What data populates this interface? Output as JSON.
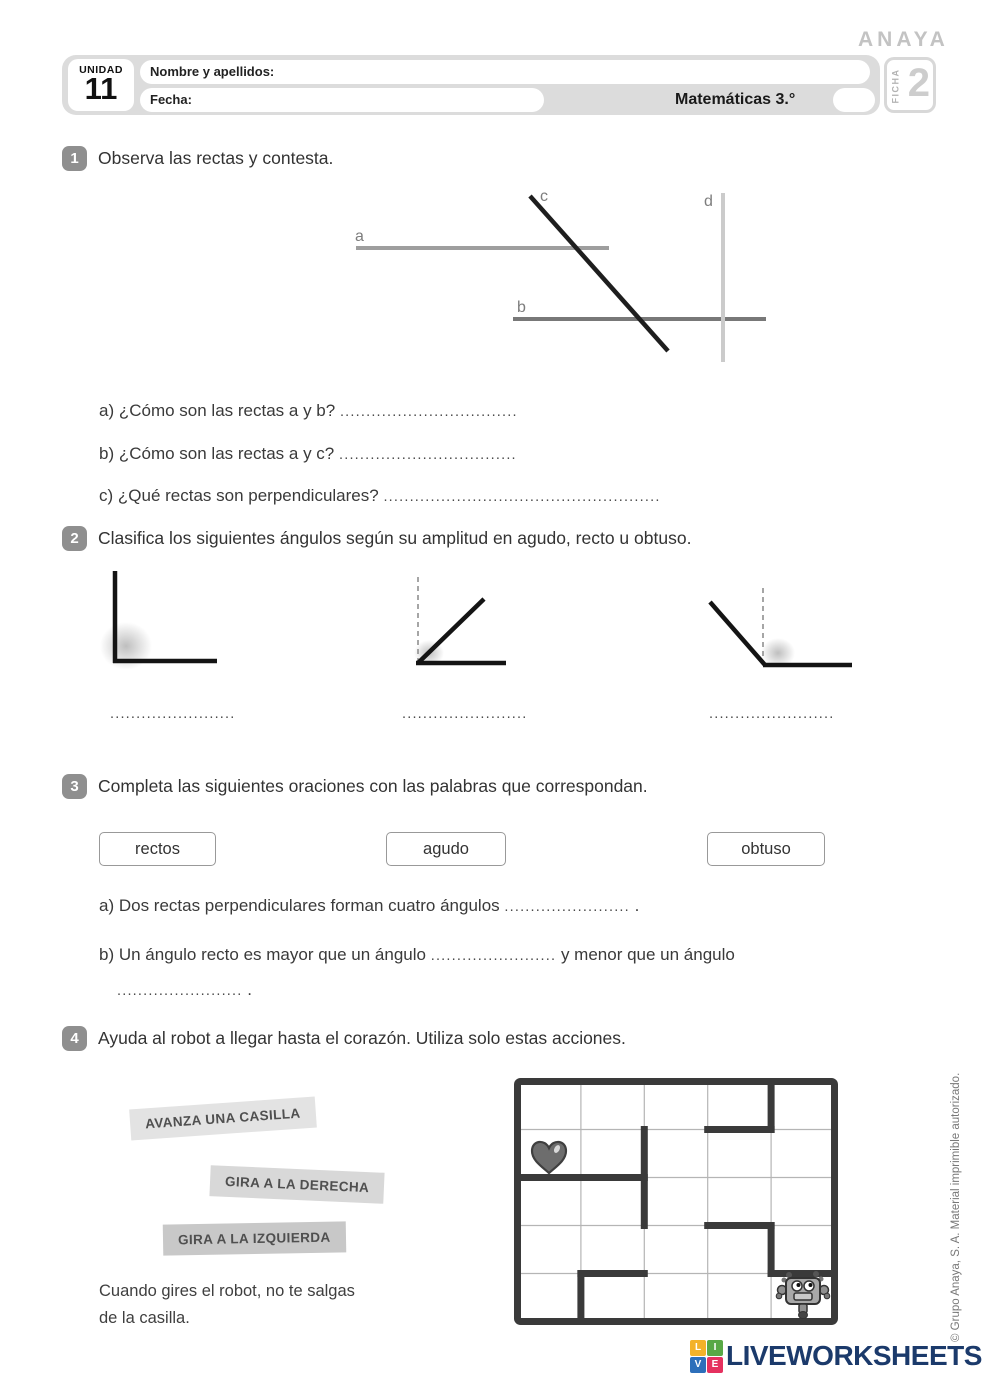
{
  "brand": {
    "publisher_logo": "ANAYA",
    "copyright_vertical": "© Grupo Anaya, S. A. Material imprimible autorizado."
  },
  "header": {
    "unidad_label": "UNIDAD",
    "unidad_number": "11",
    "nombre_label": "Nombre y apellidos:",
    "fecha_label": "Fecha:",
    "subject": "Matemáticas 3.°",
    "ficha_label": "FICHA",
    "ficha_number": "2"
  },
  "exercise1": {
    "number": "1",
    "title": "Observa las rectas y contesta.",
    "line_labels": {
      "a": "a",
      "b": "b",
      "c": "c",
      "d": "d"
    },
    "questions": [
      {
        "text": "a) ¿Cómo son las rectas a y b?",
        "dots": ".................................."
      },
      {
        "text": "b) ¿Cómo son las rectas a y c?",
        "dots": ".................................."
      },
      {
        "text": "c) ¿Qué rectas son perpendiculares?",
        "dots": "....................................................."
      }
    ]
  },
  "exercise2": {
    "number": "2",
    "title": "Clasifica los siguientes ángulos según su amplitud en agudo, recto u obtuso.",
    "answer_dots": "........................"
  },
  "exercise3": {
    "number": "3",
    "title": "Completa las siguientes oraciones con las palabras que correspondan.",
    "word_options": [
      "rectos",
      "agudo",
      "obtuso"
    ],
    "sentence_a": {
      "text": "a) Dos rectas perpendiculares forman cuatro ángulos",
      "dots": "........................",
      "period": " ."
    },
    "sentence_b": {
      "text": "b) Un ángulo recto es mayor que un ángulo",
      "dots1": "........................",
      "text2": " y menor que un ángulo",
      "dots2": "........................",
      "period": " ."
    }
  },
  "exercise4": {
    "number": "4",
    "title": "Ayuda al robot a llegar hasta el corazón. Utiliza solo estas acciones.",
    "actions": [
      "AVANZA UNA CASILLA",
      "GIRA A LA DERECHA",
      "GIRA A LA IZQUIERDA"
    ],
    "note_line1": "Cuando gires el robot, no te salgas",
    "note_line2": "de la casilla.",
    "maze": {
      "rows": 5,
      "cols": 5,
      "heart_cell": [
        1,
        0
      ],
      "robot_cell": [
        4,
        4
      ]
    }
  },
  "footer": {
    "logo_text": "LIVEWORKSHEETS",
    "logo_text_color": "#1b3a6b",
    "logo_squares": [
      {
        "letter": "L",
        "color": "#f3b229"
      },
      {
        "letter": "I",
        "color": "#58a846"
      },
      {
        "letter": "V",
        "color": "#2d6fba"
      },
      {
        "letter": "E",
        "color": "#e5315f"
      }
    ]
  }
}
